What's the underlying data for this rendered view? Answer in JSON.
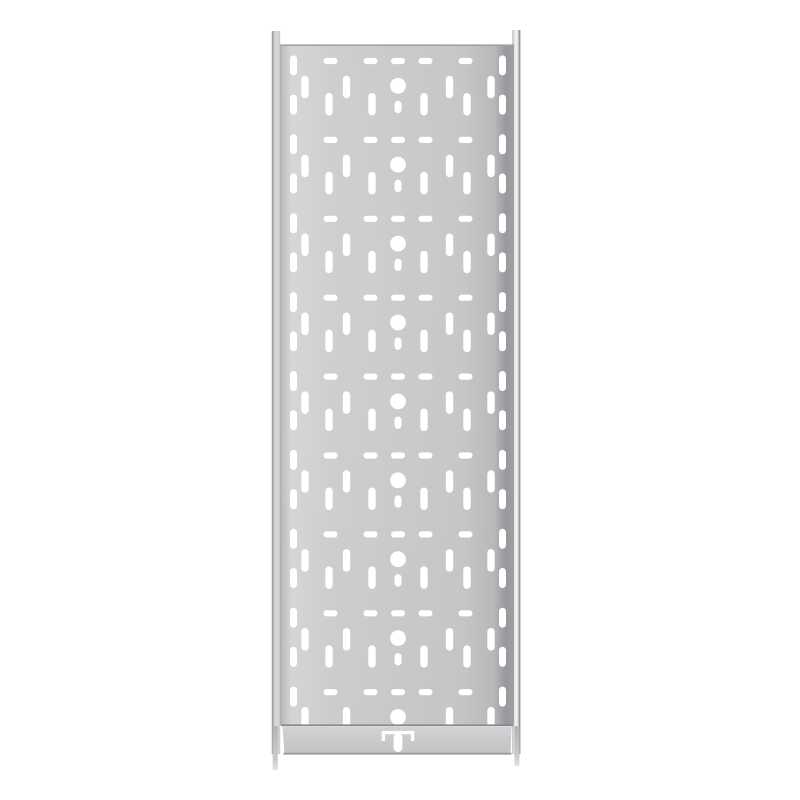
{
  "meta": {
    "subject": "perforated-galvanised-steel-cable-tray-top-view",
    "background_color": "#ffffff"
  },
  "palette": {
    "background": "#ffffff",
    "hole_fill": "#ffffff",
    "top_edge_line": "#9fa1a3",
    "fold_line": "#87898b",
    "bottom_edge_line": "#95979a",
    "plate_gradient": [
      [
        0,
        "#aaacae"
      ],
      [
        0.015,
        "#bfc1c3"
      ],
      [
        0.05,
        "#d3d5d6"
      ],
      [
        0.22,
        "#cacccd"
      ],
      [
        0.5,
        "#c6c8ca"
      ],
      [
        0.78,
        "#c3c5c7"
      ],
      [
        0.915,
        "#b6b8ba"
      ],
      [
        0.965,
        "#96989b"
      ],
      [
        1,
        "#9ea0a3"
      ]
    ],
    "rail_left_gradient": [
      [
        0,
        "#898b8d"
      ],
      [
        0.15,
        "#b0b2b4"
      ],
      [
        0.45,
        "#d8dadb"
      ],
      [
        0.75,
        "#d2d4d5"
      ],
      [
        1,
        "#c6c8ca"
      ]
    ],
    "rail_right_gradient": [
      [
        0,
        "#b9bbbd"
      ],
      [
        0.3,
        "#e6e8e9"
      ],
      [
        0.52,
        "#f3f4f4"
      ],
      [
        0.72,
        "#d5d7d8"
      ],
      [
        0.86,
        "#8d8f91"
      ],
      [
        1,
        "#a9abad"
      ]
    ],
    "flange_gradient": [
      [
        0,
        "#d0d2d4"
      ],
      [
        0.45,
        "#c9cbcd"
      ],
      [
        1,
        "#c0c2c4"
      ]
    ],
    "pin_gradient": [
      [
        0,
        "#b3b5b7"
      ],
      [
        0.75,
        "#c8cacb"
      ],
      [
        1,
        "#e2e3e4"
      ]
    ],
    "sheen_color": "#ffffff",
    "sheen_opacity": 0.08
  },
  "geometry": {
    "canvas": {
      "width": 800,
      "height": 800
    },
    "center_x": 398,
    "plate": {
      "left": 280,
      "right": 514,
      "top": 45,
      "fold_y": 726,
      "bottom": 754.5
    },
    "rail_left": {
      "x": 271.8,
      "width": 8.4,
      "top": 31,
      "bottom": 754
    },
    "rail_right": {
      "x": 512.2,
      "width": 8.3,
      "top": 30,
      "bottom": 754
    },
    "pin_left": {
      "x": 272.6,
      "width": 5.2,
      "top": 726,
      "bottom": 770
    },
    "pin_right": {
      "x": 514.4,
      "width": 5.0,
      "top": 726,
      "bottom": 766
    },
    "flange": {
      "top_left": 282.5,
      "top_right": 511.5,
      "bottom_left": 284.5,
      "bottom_right": 510.5,
      "top": 726.8,
      "bottom": 754.5
    },
    "lines": {
      "top_edge_y": 44.4,
      "top_edge_h": 1.6,
      "fold_y": 725.2,
      "fold_h": 1.8,
      "bottom_edge_y": 752.8,
      "bottom_edge_h": 1.8
    },
    "pattern": {
      "row_start_y": 85.8,
      "row_pitch": 78.9,
      "row_count": 9,
      "dash_row": {
        "dy": -24.8,
        "offsets": [
          0,
          27.5,
          67.5
        ],
        "w": 14,
        "h": 6.2
      },
      "upper_slots": {
        "dy": 1.2,
        "offsets": [
          51.5,
          93
        ],
        "w": 7.4,
        "h": 22.5
      },
      "lower_slots": {
        "dy": 18.4,
        "offsets": [
          26,
          69
        ],
        "w": 7.4,
        "h": 22.5
      },
      "center_slot": {
        "dy": 21.2,
        "w": 7,
        "h": 12.4
      },
      "round_hole": {
        "r": 7.9
      },
      "edge_columns": {
        "offset": 104.5,
        "w": 7,
        "h": 20,
        "dys": [
          -20.4,
          18.8
        ]
      },
      "last_row_skip": [
        "lower_slots",
        "center_slot",
        "edge_lower"
      ]
    },
    "coupler_tab": {
      "bracket_half_width": 14.6,
      "bracket_top": 732.6,
      "bracket_bottom": 741,
      "bracket_stroke": 3.4,
      "stem_w": 8.8,
      "stem_top": 733.5,
      "stem_bottom": 752,
      "stem_radius": 4.2
    }
  }
}
